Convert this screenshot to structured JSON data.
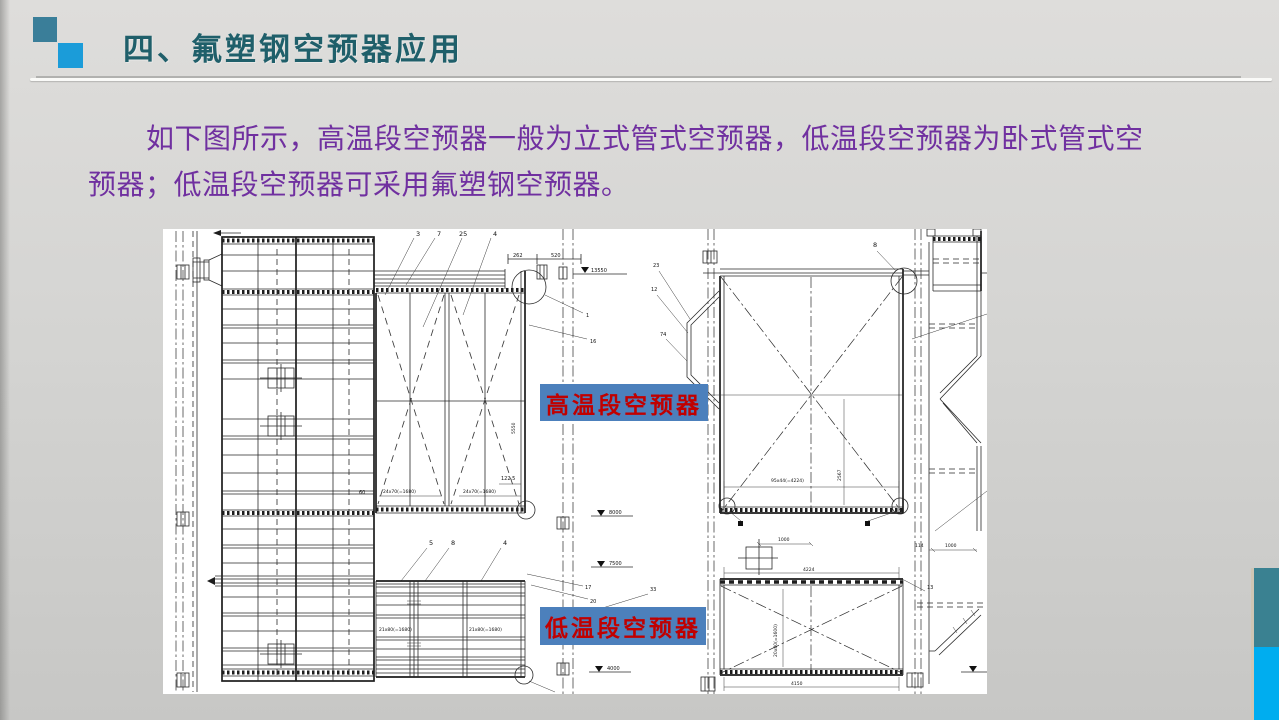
{
  "slide": {
    "title": "四、氟塑钢空预器应用",
    "body": {
      "line1": "如下图所示，高温段空预器一般为立式管式空预器，低温段空预器为卧式管式空",
      "line2": "预器；低温段空预器可采用氟塑钢空预器。"
    },
    "theme": {
      "title_color": "#1F5F6A",
      "body_color": "#7030A0",
      "square_teal": "#3A7E99",
      "square_blue": "#1B9CD9",
      "sidebar_teal": "#3A8191",
      "sidebar_blue": "#00ADEF",
      "label_bg": "#4C80BC",
      "label_text": "#C00000"
    }
  },
  "diagram": {
    "labels": {
      "high_temp": "高温段空预器",
      "low_temp": "低温段空预器"
    },
    "elevations": {
      "top": "13550",
      "e8000": "8000",
      "e7500": "7500",
      "e4000": "4000"
    },
    "dims": {
      "d262": "262",
      "d520": "520",
      "d122_5": "122.5",
      "d60": "60",
      "tube_row_high": "24x70(=1680)",
      "tube_row_low": "21x80(=1680)",
      "panel_width": "95x44(=4224)",
      "d1000": "1000",
      "d4224": "4224",
      "d4150": "4150",
      "d5550": "5550",
      "d2567": "2567",
      "d114": "114",
      "tube_col_low2": "20x80(=1600)"
    },
    "callouts": {
      "c3": "3",
      "c7": "7",
      "c25": "25",
      "c4": "4",
      "c1": "1",
      "c16": "16",
      "c5": "5",
      "c8": "8",
      "c4b": "4",
      "c17": "17",
      "c20": "20",
      "c33": "33",
      "c23": "23",
      "c12": "12",
      "c74": "74",
      "c8b": "8",
      "c13": "13"
    }
  }
}
